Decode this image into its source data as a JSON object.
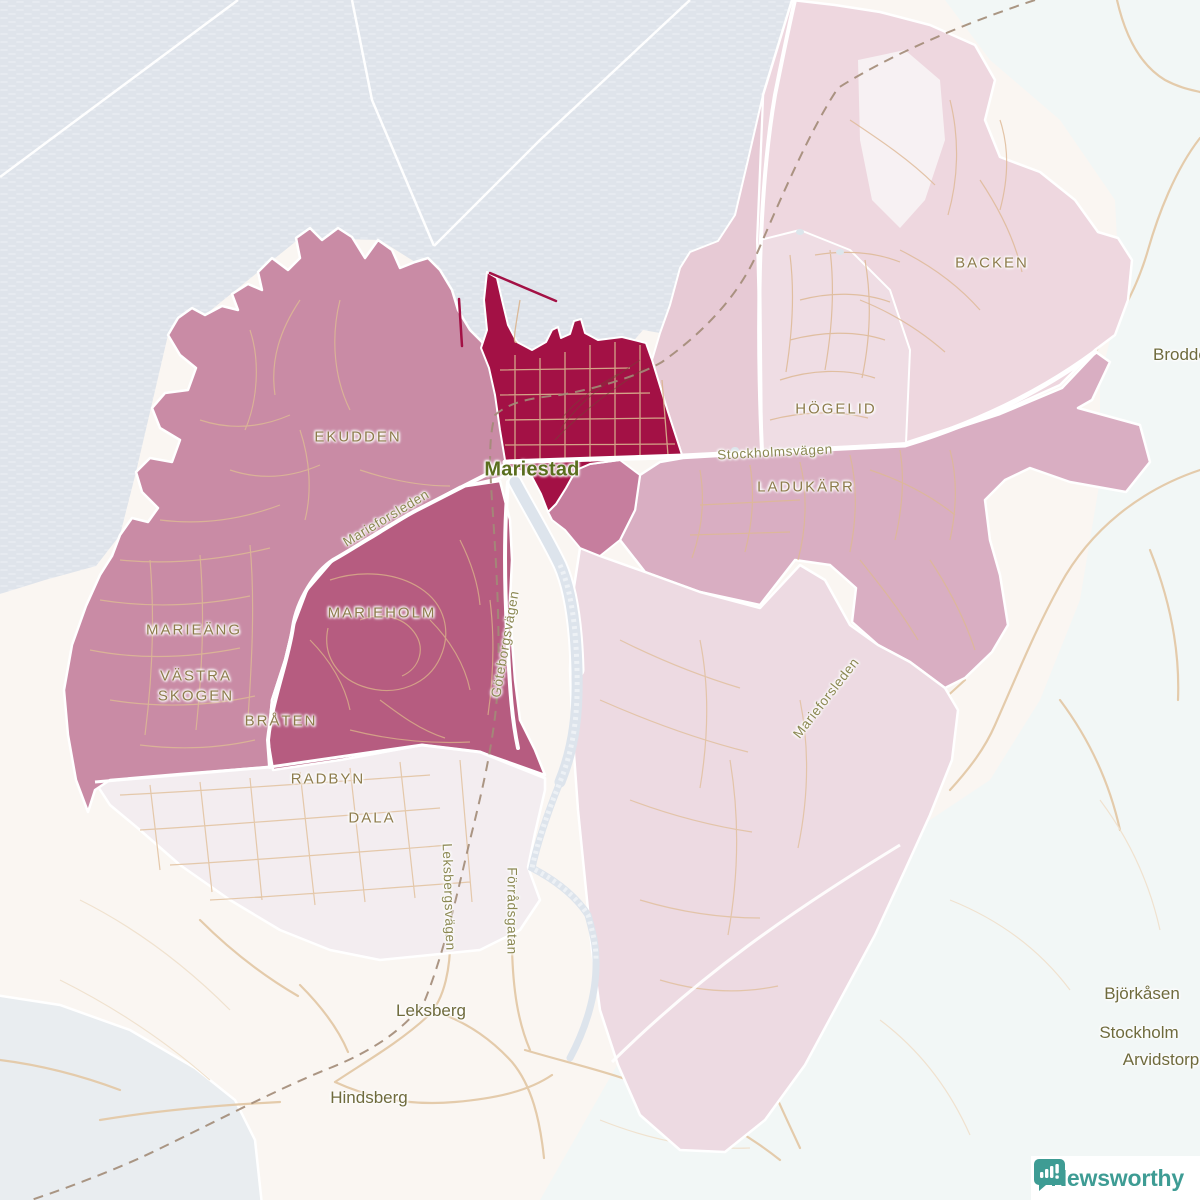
{
  "colors": {
    "water": "#dfe4eb",
    "land": "#faf6f2",
    "land_cool": "#f2f7f6",
    "land_gray": "#e9edf0",
    "district_strong": "#a31145",
    "district_dark": "#b65c80",
    "district_medium_dark": "#c67e9e",
    "district_medium": "#c98ba5",
    "district_mid_light": "#d9aec2",
    "district_strip": "#e7cad5",
    "district_hogelid": "#efdde4",
    "district_backen": "#eed7df",
    "district_southeast": "#eddae2",
    "district_faint": "#f3edf0",
    "clearing": "#f7f1f3",
    "road_white": "#ffffff",
    "road_tan": "#e4cbab",
    "road_tan_thin": "#ddb894",
    "field_line": "#f0e2cf",
    "railway": "#a28b77",
    "river": "#dde4ec",
    "logo_teal": "#3e9c94"
  },
  "logo": {
    "text": "Newsworthy"
  },
  "map": {
    "city": "Mariestad",
    "labels": [
      {
        "id": "city-label-mariestad",
        "text": "Mariestad",
        "x": 532,
        "y": 470,
        "rot": 0,
        "cls": "city"
      },
      {
        "id": "district-label-ekudden",
        "text": "EKUDDEN",
        "x": 358,
        "y": 437,
        "rot": 0,
        "cls": "district"
      },
      {
        "id": "district-label-marieang",
        "text": "MARIEÄNG",
        "x": 194,
        "y": 630,
        "rot": 0,
        "cls": "district"
      },
      {
        "id": "district-label-vastra-skogen",
        "text": "VÄSTRA\nSKOGEN",
        "x": 196,
        "y": 686,
        "rot": 0,
        "cls": "district"
      },
      {
        "id": "district-label-braten",
        "text": "BRÅTEN",
        "x": 281,
        "y": 721,
        "rot": 0,
        "cls": "district"
      },
      {
        "id": "district-label-marieholm",
        "text": "MARIEHOLM",
        "x": 382,
        "y": 613,
        "rot": 0,
        "cls": "district"
      },
      {
        "id": "district-label-radbyn",
        "text": "RADBYN",
        "x": 328,
        "y": 779,
        "rot": 0,
        "cls": "district"
      },
      {
        "id": "district-label-dala",
        "text": "DALA",
        "x": 372,
        "y": 818,
        "rot": 0,
        "cls": "district"
      },
      {
        "id": "district-label-hogelid",
        "text": "HÖGELID",
        "x": 836,
        "y": 409,
        "rot": 0,
        "cls": "district"
      },
      {
        "id": "district-label-ladukarr",
        "text": "LADUKÄRR",
        "x": 806,
        "y": 487,
        "rot": 0,
        "cls": "district"
      },
      {
        "id": "district-label-backen",
        "text": "BACKEN",
        "x": 992,
        "y": 263,
        "rot": 0,
        "cls": "district"
      },
      {
        "id": "place-label-leksberg",
        "text": "Leksberg",
        "x": 431,
        "y": 1011,
        "rot": 0,
        "cls": "place"
      },
      {
        "id": "place-label-hindsberg",
        "text": "Hindsberg",
        "x": 369,
        "y": 1098,
        "rot": 0,
        "cls": "place"
      },
      {
        "id": "place-label-bjorkasen",
        "text": "Björkåsen",
        "x": 1142,
        "y": 994,
        "rot": 0,
        "cls": "place"
      },
      {
        "id": "place-label-stockholm",
        "text": "Stockholm",
        "x": 1139,
        "y": 1033,
        "rot": 0,
        "cls": "place"
      },
      {
        "id": "place-label-arvidstorp",
        "text": "Arvidstorp",
        "x": 1161,
        "y": 1060,
        "rot": 0,
        "cls": "place"
      },
      {
        "id": "place-label-brodderud",
        "text": "Brodderud",
        "x": 1153,
        "y": 355,
        "rot": 0,
        "cls": "place",
        "anchor": "start"
      },
      {
        "id": "road-label-stockholmsvagen",
        "text": "Stockholmsvägen",
        "x": 775,
        "y": 452,
        "rot": -3,
        "cls": "road"
      },
      {
        "id": "road-label-goteborgsvagen",
        "text": "Göteborgsvägen",
        "x": 505,
        "y": 644,
        "rot": -80,
        "cls": "road"
      },
      {
        "id": "road-label-marieforsleden-nw",
        "text": "Marieforsleden",
        "x": 386,
        "y": 518,
        "rot": -31,
        "cls": "road"
      },
      {
        "id": "road-label-marieforsleden-se",
        "text": "Marieforsleden",
        "x": 826,
        "y": 698,
        "rot": -52,
        "cls": "road"
      },
      {
        "id": "road-label-leksbergsvagen",
        "text": "Leksbergsvägen",
        "x": 449,
        "y": 897,
        "rot": 88,
        "cls": "road"
      },
      {
        "id": "road-label-forradsgatan",
        "text": "Förrådsgatan",
        "x": 512,
        "y": 911,
        "rot": 90,
        "cls": "road"
      }
    ]
  }
}
